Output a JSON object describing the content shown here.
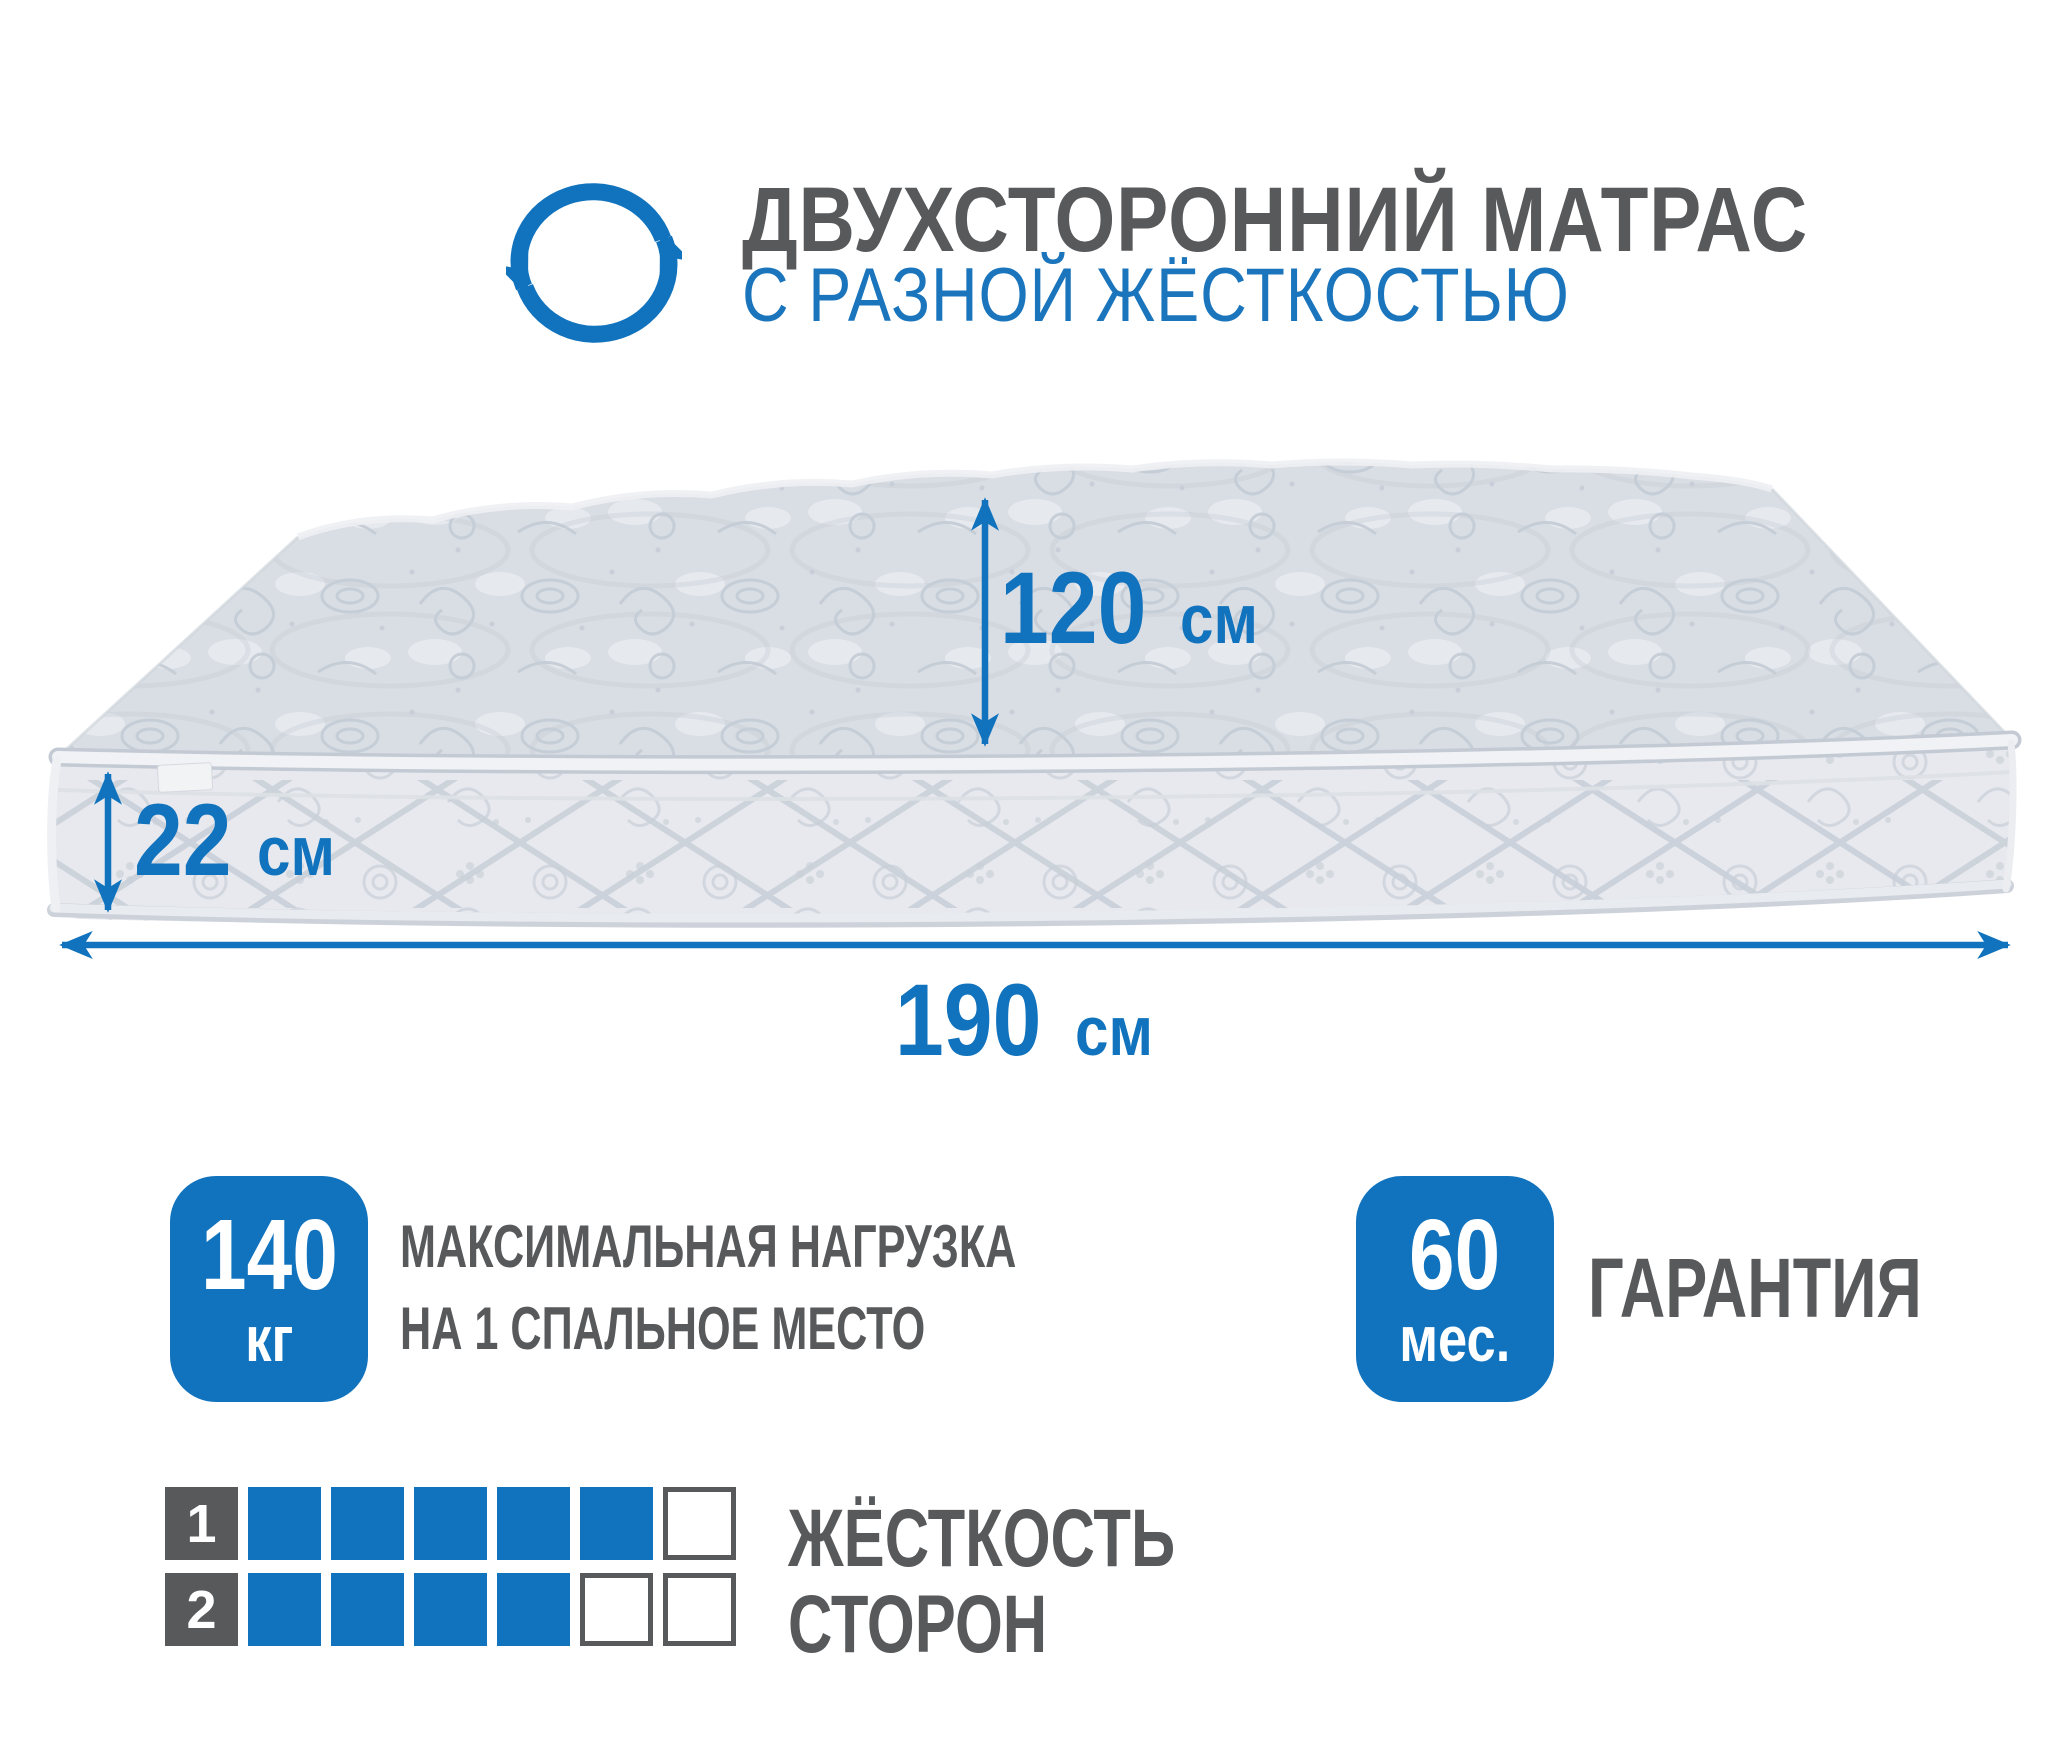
{
  "header": {
    "title": "ДВУХСТОРОННИЙ МАТРАС",
    "subtitle": "С РАЗНОЙ ЖЁСТКОСТЬЮ"
  },
  "dimensions": {
    "depth": {
      "value": "120",
      "unit": "см"
    },
    "height": {
      "value": "22",
      "unit": "см"
    },
    "length": {
      "value": "190",
      "unit": "см"
    }
  },
  "badges": {
    "max_load": {
      "value": "140",
      "unit": "кг",
      "label_line1": "МАКСИМАЛЬНАЯ НАГРУЗКА",
      "label_line2": "НА 1 СПАЛЬНОЕ МЕСТО"
    },
    "warranty": {
      "value": "60",
      "unit": "мес.",
      "label": "ГАРАНТИЯ"
    }
  },
  "firmness": {
    "caption_line1": "ЖЁСТКОСТЬ",
    "caption_line2": "СТОРОН",
    "scale_max": 6,
    "sides": [
      {
        "label": "1",
        "value": 5
      },
      {
        "label": "2",
        "value": 4
      }
    ]
  },
  "colors": {
    "accent_blue": "#1173bd",
    "text_gray": "#58595b",
    "mattress_top": "#d9dde4",
    "mattress_side": "#e7e9ee"
  }
}
